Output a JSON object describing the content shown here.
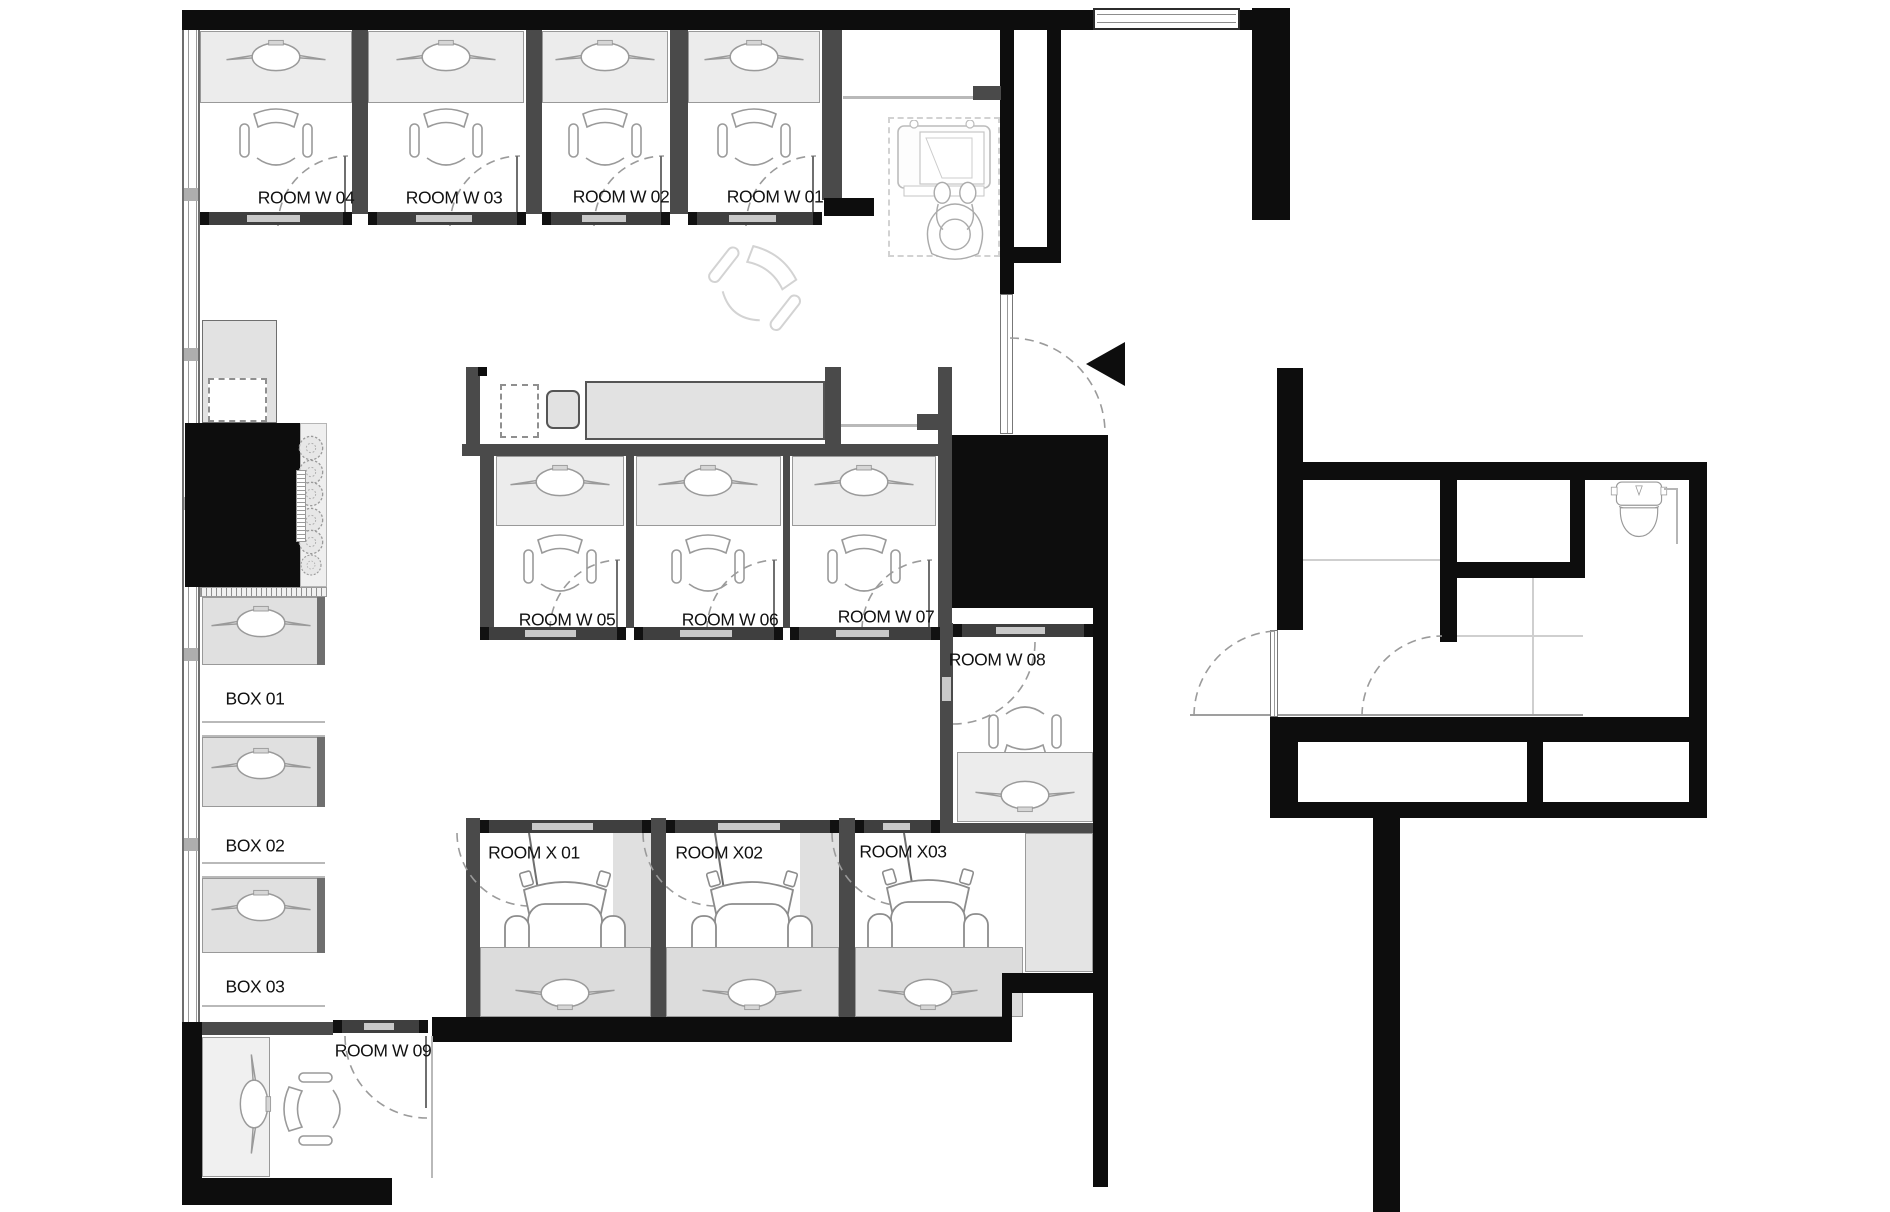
{
  "labels": {
    "room_w01": "ROOM W 01",
    "room_w02": "ROOM W 02",
    "room_w03": "ROOM W 03",
    "room_w04": "ROOM W 04",
    "room_w05": "ROOM W 05",
    "room_w06": "ROOM W 06",
    "room_w07": "ROOM W 07",
    "room_w08": "ROOM W 08",
    "room_w09": "ROOM W 09",
    "box_01": "BOX 01",
    "box_02": "BOX 02",
    "box_03": "BOX 03",
    "room_x01": "ROOM X 01",
    "room_x02": "ROOM X02",
    "room_x03": "ROOM X03"
  },
  "colors": {
    "wall": "#0d0d0d",
    "partition": "#4a4a4a",
    "desk_fill": "#ececec",
    "desk_stroke": "#999999",
    "counter_fill": "#e2e2e2",
    "door_arc": "#9b9b9b",
    "track": "#3f3f3f",
    "track_slider": "#c9c9c9",
    "furniture_stroke": "#9a9a9a",
    "faint_stroke": "#bdbdbd",
    "label_text": "#111111"
  }
}
